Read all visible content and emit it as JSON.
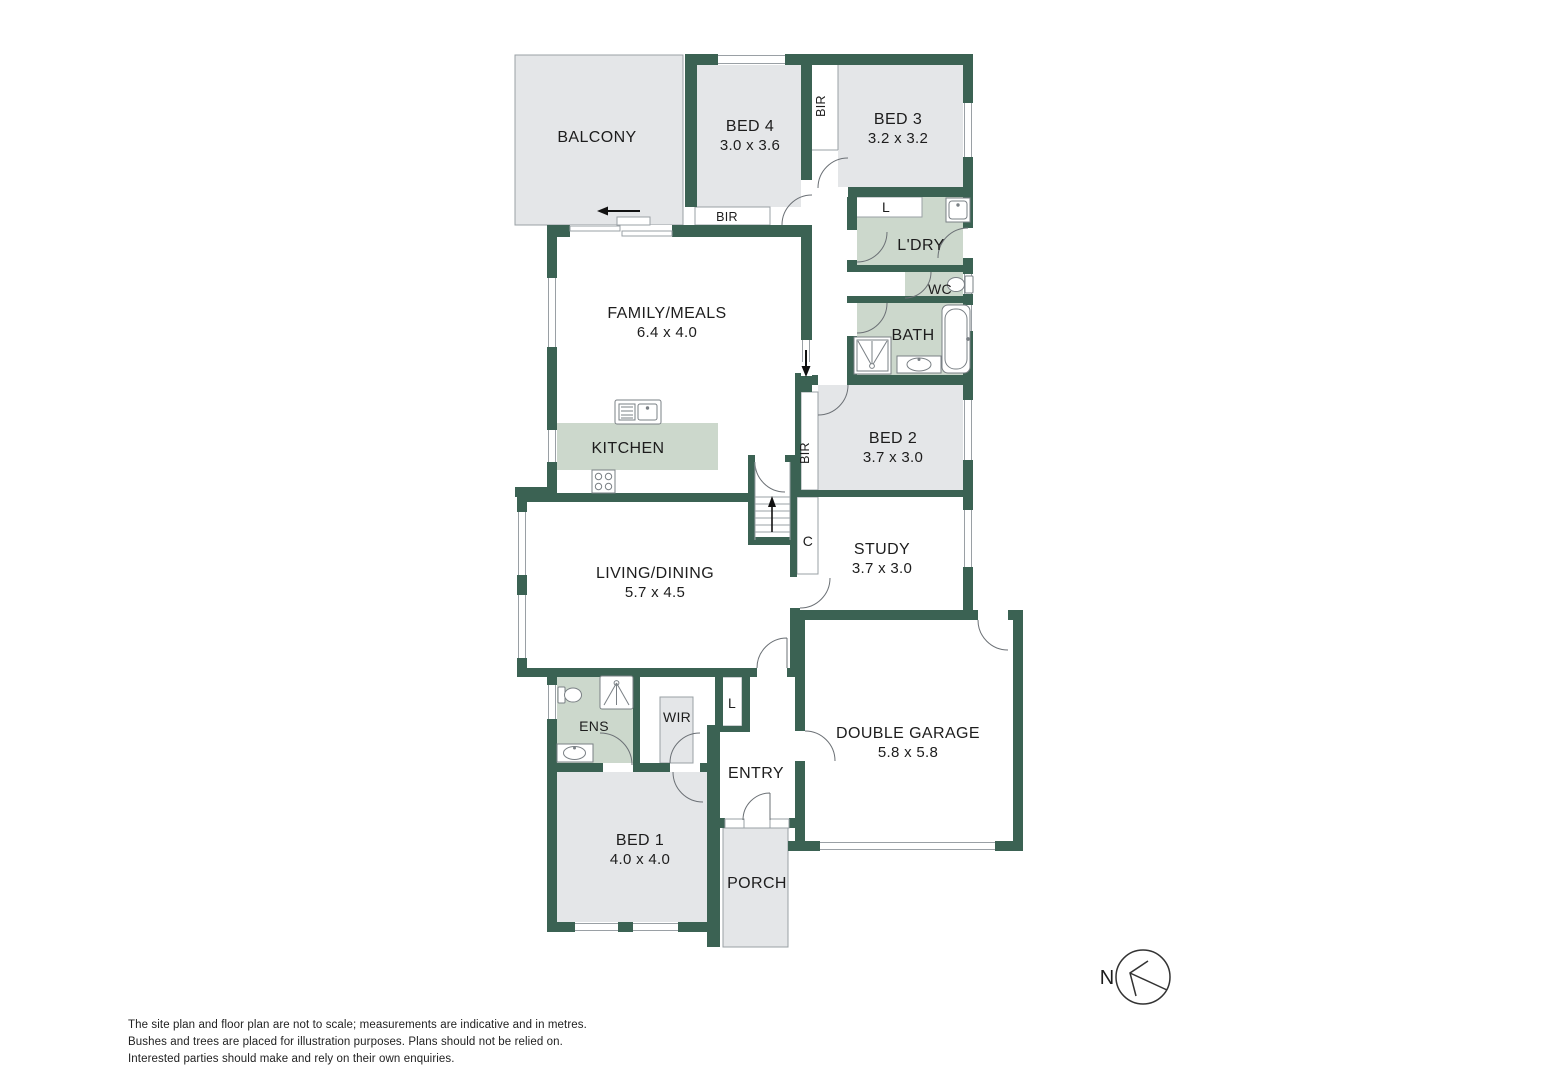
{
  "rooms": {
    "balcony": {
      "name": "BALCONY"
    },
    "bed4": {
      "name": "BED 4",
      "dims": "3.0 x 3.6"
    },
    "bed3": {
      "name": "BED 3",
      "dims": "3.2 x 3.2"
    },
    "bir_bed3": {
      "name": "BIR"
    },
    "bir_bed4": {
      "name": "BIR"
    },
    "linen_upper": {
      "name": "L"
    },
    "laundry": {
      "name": "L'DRY"
    },
    "wc": {
      "name": "WC"
    },
    "bath": {
      "name": "BATH"
    },
    "family": {
      "name": "FAMILY/MEALS",
      "dims": "6.4 x 4.0"
    },
    "kitchen": {
      "name": "KITCHEN"
    },
    "bed2": {
      "name": "BED 2",
      "dims": "3.7 x 3.0"
    },
    "bir_bed2": {
      "name": "BIR"
    },
    "closet_c": {
      "name": "C"
    },
    "study": {
      "name": "STUDY",
      "dims": "3.7 x 3.0"
    },
    "living": {
      "name": "LIVING/DINING",
      "dims": "5.7 x 4.5"
    },
    "ens": {
      "name": "ENS"
    },
    "wir": {
      "name": "WIR"
    },
    "linen_lower": {
      "name": "L"
    },
    "entry": {
      "name": "ENTRY"
    },
    "garage": {
      "name": "DOUBLE GARAGE",
      "dims": "5.8 x 5.8"
    },
    "bed1": {
      "name": "BED 1",
      "dims": "4.0 x 4.0"
    },
    "porch": {
      "name": "PORCH"
    }
  },
  "compass": {
    "north_label": "N"
  },
  "disclaimer": {
    "line1": "The site plan and floor plan are not to scale; measurements are indicative and in metres.",
    "line2": "Bushes and trees are placed for illustration purposes. Plans should not be relied on.",
    "line3": "Interested parties should make and rely on their own enquiries."
  },
  "colors": {
    "wall": "#3b6253",
    "room_fill": "#e4e6e8",
    "wet_fill": "#ccd8cc",
    "thin_line": "#9aa0a5"
  }
}
